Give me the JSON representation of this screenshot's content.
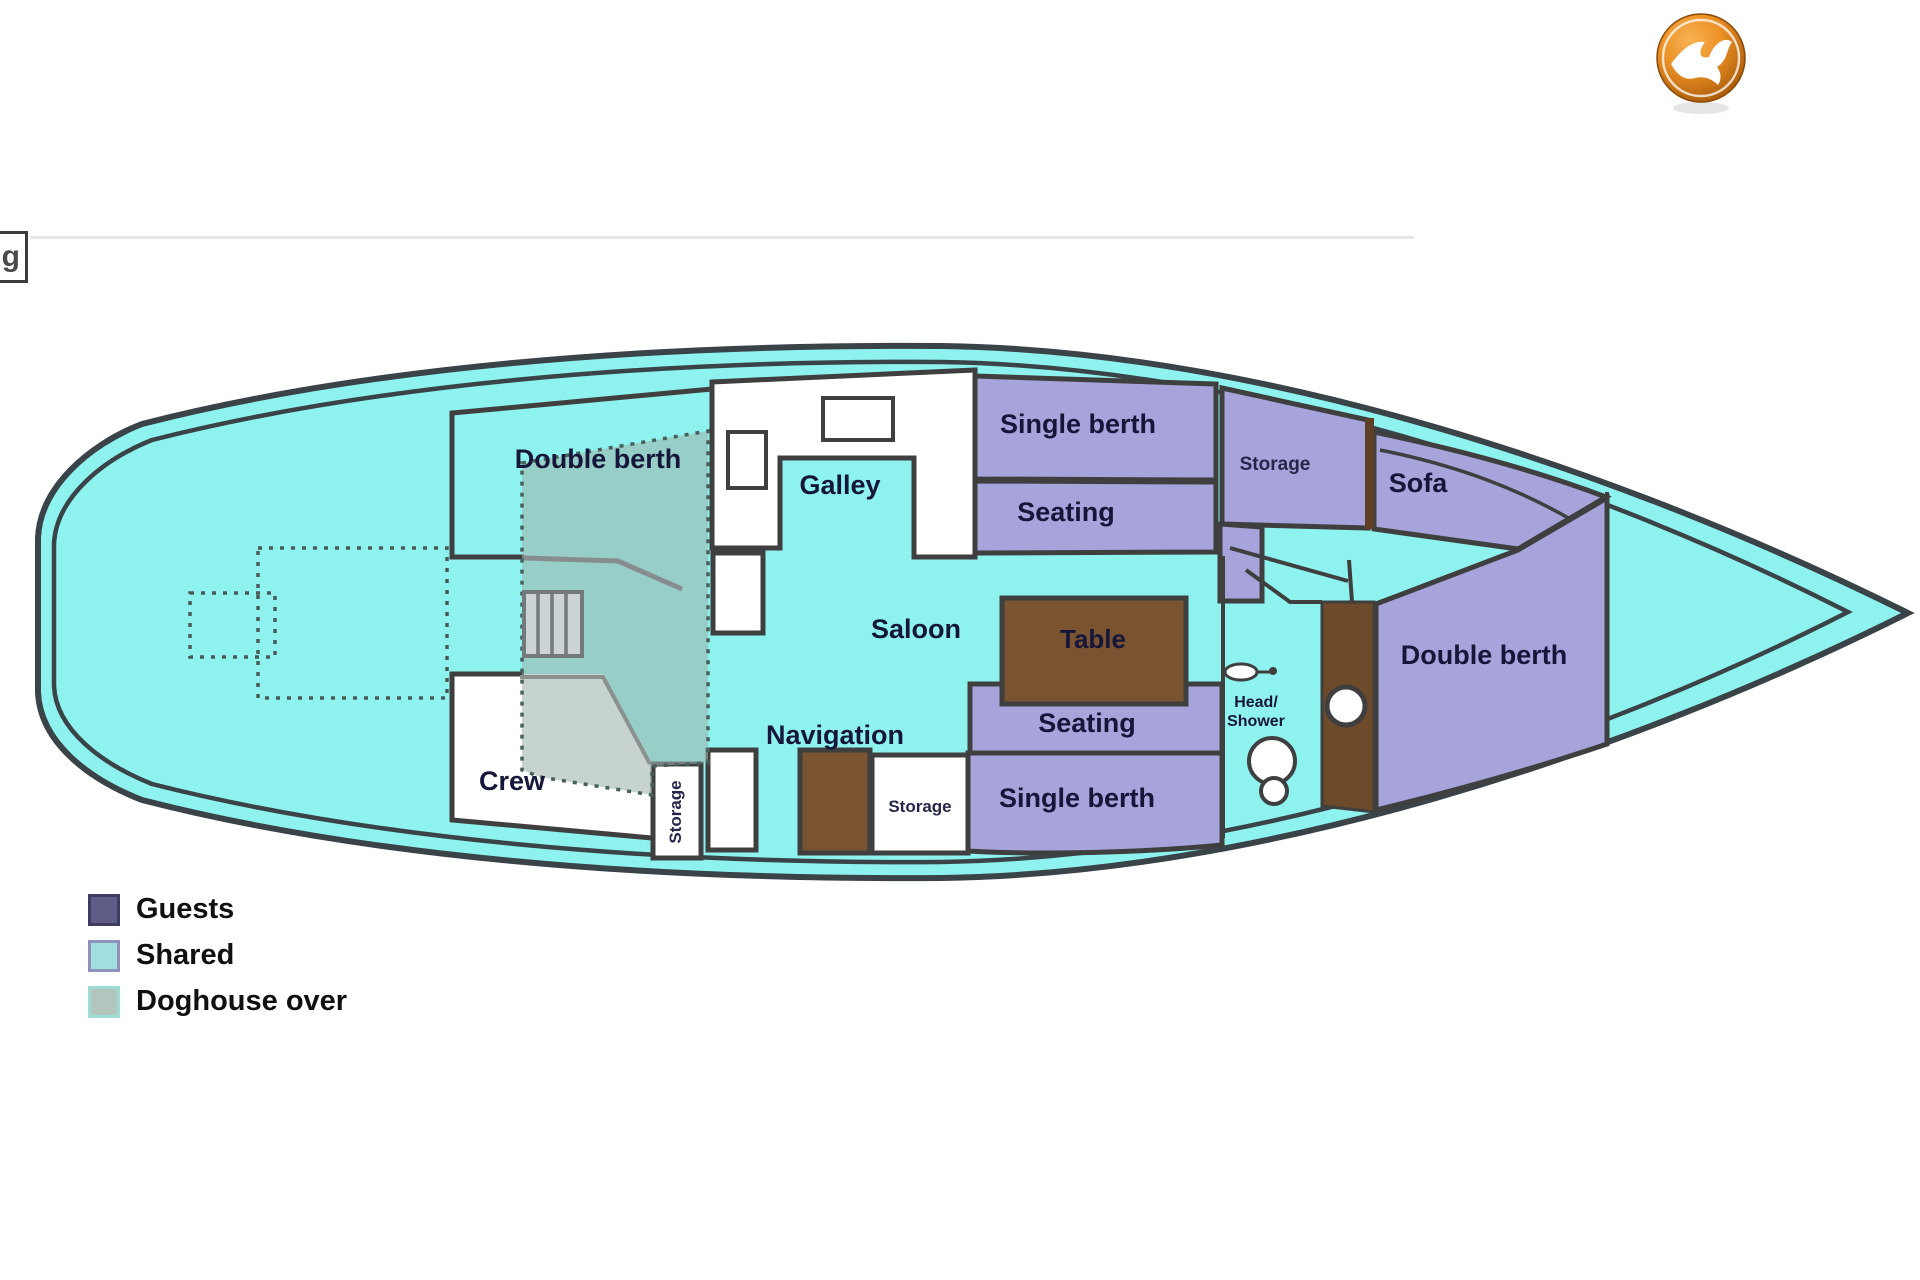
{
  "topbar": {
    "partial_button_label": "g"
  },
  "logo": {
    "title": "bird logo",
    "orange_light": "#f7b254",
    "orange_mid": "#ed9226",
    "orange_dark": "#a85a08"
  },
  "plan": {
    "title": "Boat deck layout",
    "rooms": {
      "double_berth_aft": "Double berth",
      "galley": "Galley",
      "saloon": "Saloon",
      "single_berth_top": "Single berth",
      "seating_top": "Seating",
      "storage_top": "Storage",
      "sofa": "Sofa",
      "table": "Table",
      "seating_mid": "Seating",
      "single_berth_bottom": "Single berth",
      "navigation": "Navigation",
      "storage_mid": "Storage",
      "storage_companionway": "Storage",
      "crew": "Crew",
      "head_shower_line1": "Head/",
      "head_shower_line2": "Shower",
      "double_berth_fwd": "Double berth"
    },
    "colors": {
      "hull_fill": "#8ef2ef",
      "outline": "#3a4347",
      "guest_purple": "#a6a4da",
      "wood_brown": "#7a5431",
      "wood_dark": "#6d4a2a",
      "doghouse_overlay": "#9eb4ab",
      "room_white": "#ffffff"
    }
  },
  "legend": {
    "items": [
      {
        "label": "Guests",
        "color": "#5f5d87"
      },
      {
        "label": "Shared",
        "color": "#9fdfdf"
      },
      {
        "label": "Doghouse over",
        "color": "#b2c6bd"
      }
    ]
  }
}
